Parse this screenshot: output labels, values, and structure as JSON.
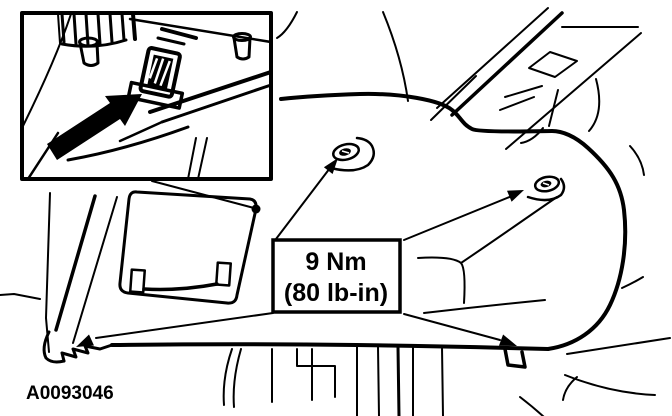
{
  "figure": {
    "type": "service-manual-line-art",
    "id_label": "A0093046",
    "torque_callout": {
      "metric": "9 Nm",
      "imperial": "(80 lb-in)"
    },
    "inset": {
      "description": "magnified detail of trim panel retainer clip",
      "pointer": "black-arrow"
    },
    "fastener_points": 4
  },
  "colors": {
    "ink": "#000000",
    "background": "#ffffff"
  }
}
